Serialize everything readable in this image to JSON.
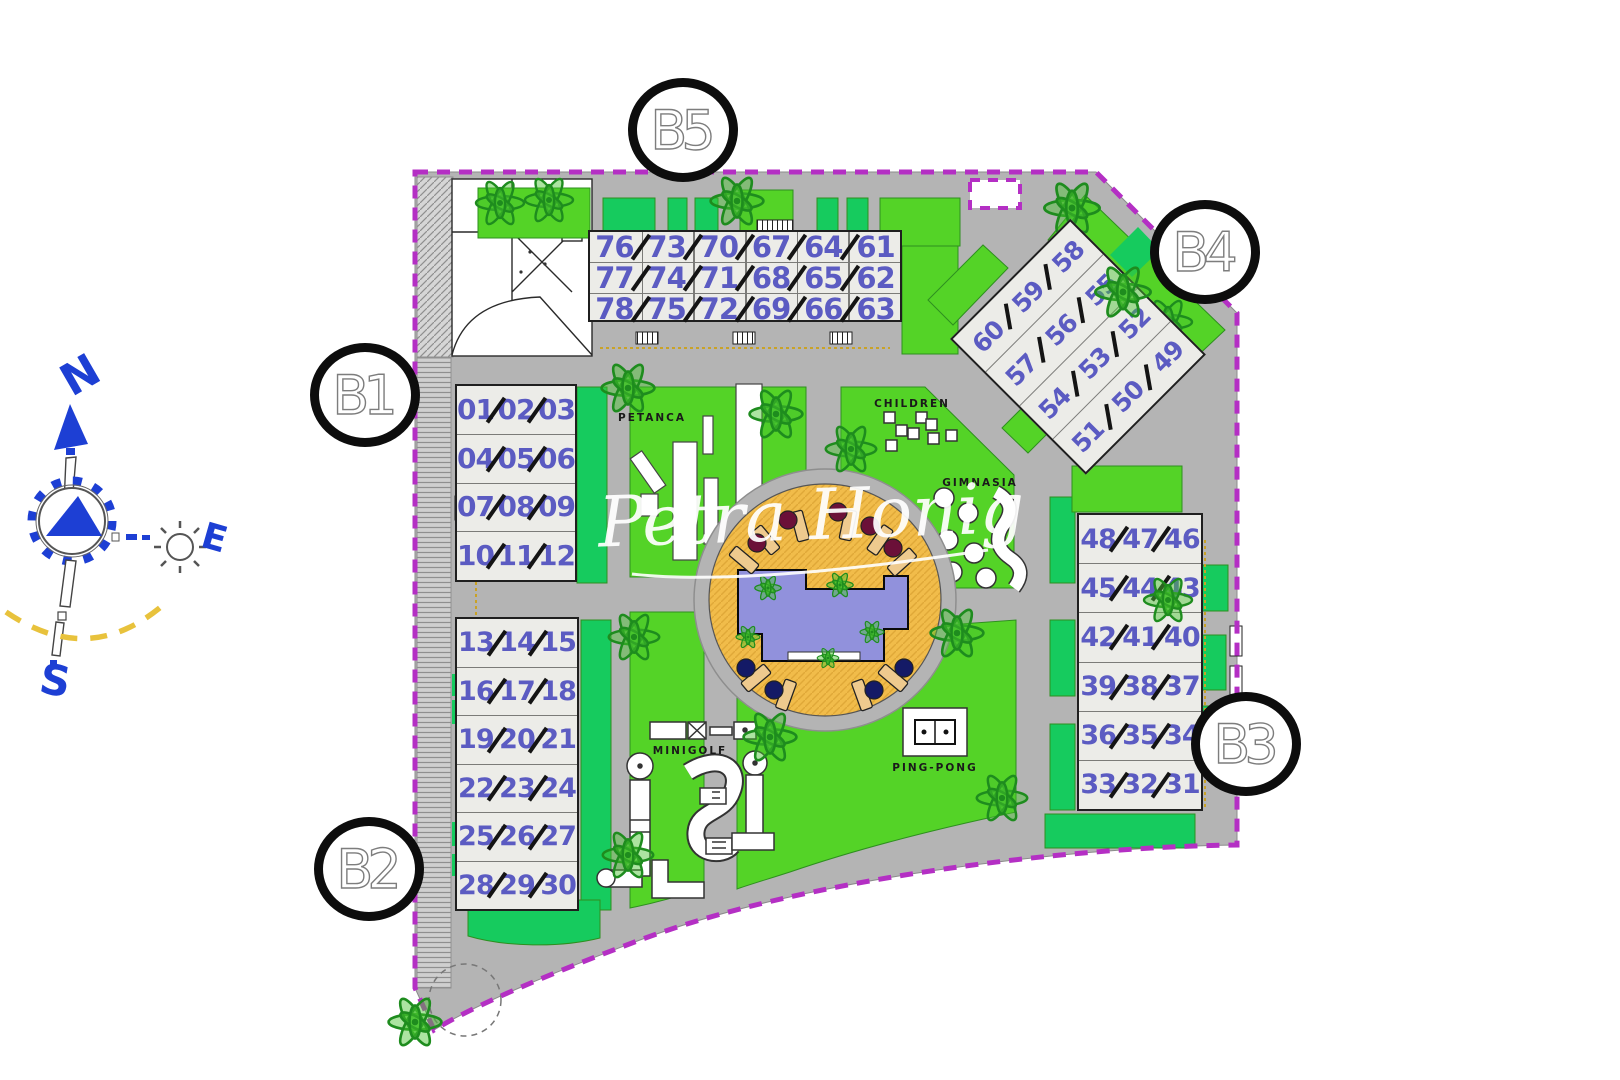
{
  "watermark": "Petra Honig",
  "compass": {
    "north": "N",
    "east": "E",
    "south": "S"
  },
  "markers": {
    "b1": "B1",
    "b2": "B2",
    "b3": "B3",
    "b4": "B4",
    "b5": "B5"
  },
  "amenities": {
    "petanca": "PETANCA",
    "children": "CHILDREN",
    "gimnasia": "GIMNASIA",
    "minigolf": "MINIGOLF",
    "ping_pong": "PING-PONG"
  },
  "buildings": {
    "b5": {
      "rows": [
        [
          "76",
          "73",
          "70",
          "67",
          "64",
          "61"
        ],
        [
          "77",
          "74",
          "71",
          "68",
          "65",
          "62"
        ],
        [
          "78",
          "75",
          "72",
          "69",
          "66",
          "63"
        ]
      ]
    },
    "b4": {
      "rows": [
        [
          "60",
          "59",
          "58"
        ],
        [
          "57",
          "56",
          "55"
        ],
        [
          "54",
          "53",
          "52"
        ],
        [
          "51",
          "50",
          "49"
        ]
      ]
    },
    "b1": {
      "rows": [
        [
          "01",
          "02",
          "03"
        ],
        [
          "04",
          "05",
          "06"
        ],
        [
          "07",
          "08",
          "09"
        ],
        [
          "10",
          "11",
          "12"
        ]
      ]
    },
    "b2": {
      "rows": [
        [
          "13",
          "14",
          "15"
        ],
        [
          "16",
          "17",
          "18"
        ],
        [
          "19",
          "20",
          "21"
        ],
        [
          "22",
          "23",
          "24"
        ],
        [
          "25",
          "26",
          "27"
        ],
        [
          "28",
          "29",
          "30"
        ]
      ]
    },
    "b3": {
      "rows": [
        [
          "48",
          "47",
          "46"
        ],
        [
          "45",
          "44",
          "43"
        ],
        [
          "42",
          "41",
          "40"
        ],
        [
          "39",
          "38",
          "37"
        ],
        [
          "36",
          "35",
          "34"
        ],
        [
          "33",
          "32",
          "31"
        ]
      ]
    }
  },
  "colors": {
    "boundary_magenta": "#b42fc4",
    "lawn_green": "#54d327",
    "emerald_green": "#16cb5e",
    "road_gray": "#b4b4b4",
    "building_fill": "#ecece8",
    "unit_number_blue": "#5b5bc2",
    "pool_blue": "#9191dc",
    "deck_orange": "#f1bc4a",
    "compass_blue": "#1d3fd4",
    "arc_yellow": "#e8c23c",
    "tree_green": "#1e8c1e",
    "marker_ring_black": "#0d0d0d"
  }
}
